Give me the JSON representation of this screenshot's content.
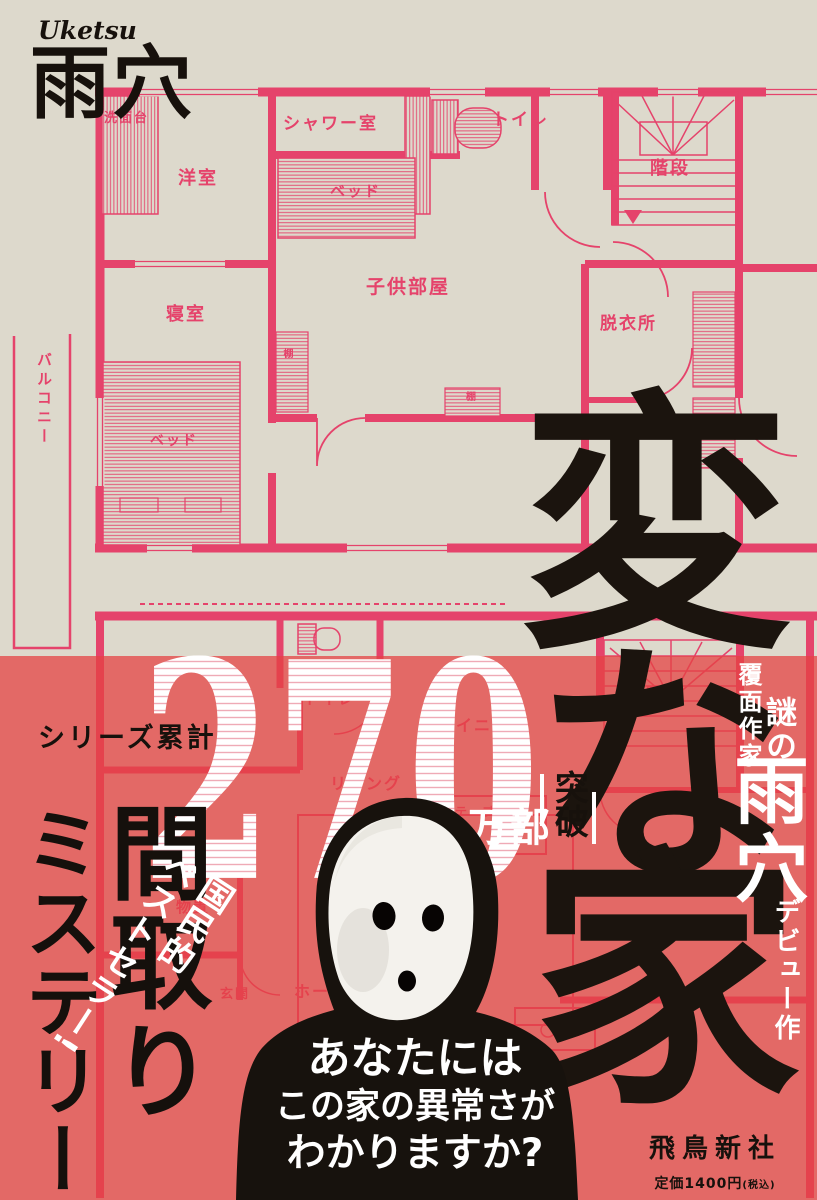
{
  "colors": {
    "background_beige": "#ddd9cc",
    "plan_pink": "#e5436b",
    "band_red": "#e36a66",
    "ink_black": "#17110c",
    "white": "#ffffff"
  },
  "author_block": {
    "romaji": "Uketsu",
    "kanji": "雨穴"
  },
  "title": {
    "char1": "変",
    "char2": "な",
    "char3": "家"
  },
  "sales": {
    "series_label": "シリーズ累計",
    "number": "270",
    "unit": "万部",
    "breakthrough": "突破"
  },
  "badge": {
    "line1": "国民的",
    "line2": "ベストセラー!"
  },
  "headline": {
    "madori": "間取り",
    "mystery": "ミステリー"
  },
  "question_lines": [
    {
      "parts": [
        {
          "t": "あなた",
          "b": true
        },
        {
          "t": "には",
          "b": false
        }
      ],
      "fs": 43
    },
    {
      "parts": [
        {
          "t": "この",
          "b": false
        },
        {
          "t": "家",
          "b": true
        },
        {
          "t": "の",
          "b": false
        },
        {
          "t": "異常",
          "b": true
        },
        {
          "t": "さが",
          "b": false
        }
      ],
      "fs": 35
    },
    {
      "parts": [
        {
          "t": "わかり",
          "b": true
        },
        {
          "t": "ますか?",
          "b": false
        }
      ],
      "fs": 39
    }
  ],
  "credit": {
    "masked_author": "覆面作家",
    "mystery_of": "謎の",
    "name": "雨穴",
    "debut": "デビュー作"
  },
  "publisher": {
    "name": "飛鳥新社",
    "price": "定価1400円",
    "tax": "(税込)"
  },
  "plan_upper_labels": [
    {
      "text": "洗面台",
      "x": 104,
      "y": 112,
      "fs": 13
    },
    {
      "text": "洋室",
      "x": 178,
      "y": 170,
      "fs": 18
    },
    {
      "text": "シャワー室",
      "x": 283,
      "y": 116,
      "fs": 17
    },
    {
      "text": "ベッド",
      "x": 330,
      "y": 184,
      "fs": 15
    },
    {
      "text": "トイレ",
      "x": 492,
      "y": 112,
      "fs": 17
    },
    {
      "text": "階段",
      "x": 650,
      "y": 160,
      "fs": 18
    },
    {
      "text": "子供部屋",
      "x": 366,
      "y": 278,
      "fs": 19
    },
    {
      "text": "寝室",
      "x": 166,
      "y": 306,
      "fs": 18
    },
    {
      "text": "棚",
      "x": 281,
      "y": 348,
      "fs": 10,
      "vert": true
    },
    {
      "text": "棚",
      "x": 466,
      "y": 393,
      "fs": 10
    },
    {
      "text": "脱衣所",
      "x": 600,
      "y": 316,
      "fs": 17
    },
    {
      "text": "バルコニー",
      "x": 36,
      "y": 352,
      "fs": 15,
      "vert": true
    },
    {
      "text": "ベッド",
      "x": 150,
      "y": 434,
      "fs": 14
    }
  ],
  "plan_lower_labels": [
    {
      "text": "トイレ",
      "x": 304,
      "y": 692,
      "fs": 15
    },
    {
      "text": "階段",
      "x": 646,
      "y": 686,
      "fs": 16
    },
    {
      "text": "ダイニング",
      "x": 438,
      "y": 718,
      "fs": 16
    },
    {
      "text": "リビング",
      "x": 330,
      "y": 776,
      "fs": 16
    },
    {
      "text": "テーブル",
      "x": 455,
      "y": 806,
      "fs": 12
    },
    {
      "text": "物置",
      "x": 176,
      "y": 900,
      "fs": 15
    },
    {
      "text": "玄関",
      "x": 220,
      "y": 988,
      "fs": 13
    },
    {
      "text": "ホール",
      "x": 294,
      "y": 984,
      "fs": 16
    }
  ]
}
